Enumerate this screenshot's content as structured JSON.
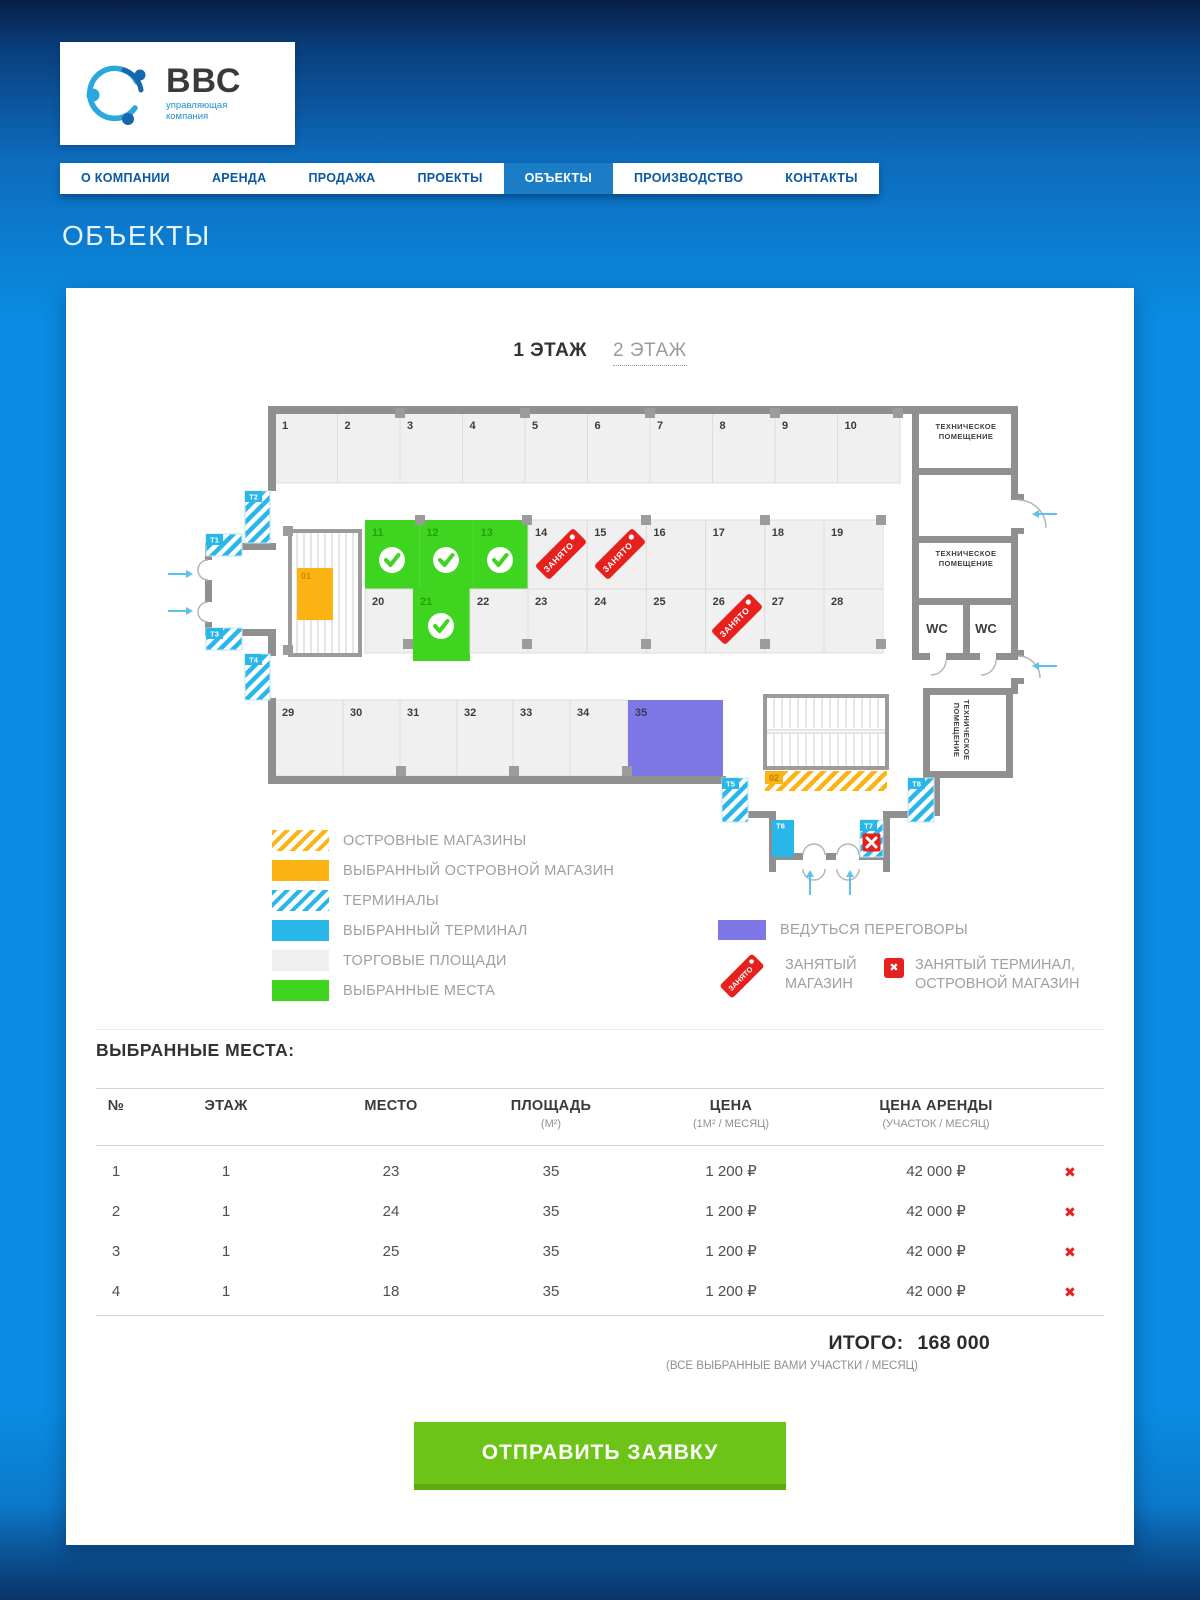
{
  "page_title": "ОБЪЕКТЫ",
  "header": {
    "logo_title": "ВВС",
    "logo_subtitle_line1": "управляющая",
    "logo_subtitle_line2": "компания"
  },
  "nav": {
    "items": [
      {
        "label": "О КОМПАНИИ",
        "active": false
      },
      {
        "label": "АРЕНДА",
        "active": false
      },
      {
        "label": "ПРОДАЖА",
        "active": false
      },
      {
        "label": "ПРОЕКТЫ",
        "active": false
      },
      {
        "label": "ОБЪЕКТЫ",
        "active": true
      },
      {
        "label": "ПРОИЗВОДСТВО",
        "active": false
      },
      {
        "label": "КОНТАКТЫ",
        "active": false
      }
    ]
  },
  "floor_tabs": [
    {
      "label": "1 ЭТАЖ",
      "active": true
    },
    {
      "label": "2 ЭТАЖ",
      "active": false
    }
  ],
  "floorplan": {
    "occupied_label": "ЗАНЯТО",
    "wc_label": "WC",
    "units": [
      {
        "n": "1",
        "x": 115,
        "y": 25,
        "w": 62.5,
        "h": 70,
        "state": "free"
      },
      {
        "n": "2",
        "x": 177.5,
        "y": 25,
        "w": 62.5,
        "h": 70,
        "state": "free"
      },
      {
        "n": "3",
        "x": 240,
        "y": 25,
        "w": 62.5,
        "h": 70,
        "state": "free"
      },
      {
        "n": "4",
        "x": 302.5,
        "y": 25,
        "w": 62.5,
        "h": 70,
        "state": "free"
      },
      {
        "n": "5",
        "x": 365,
        "y": 25,
        "w": 62.5,
        "h": 70,
        "state": "free"
      },
      {
        "n": "6",
        "x": 427.5,
        "y": 25,
        "w": 62.5,
        "h": 70,
        "state": "free"
      },
      {
        "n": "7",
        "x": 490,
        "y": 25,
        "w": 62.5,
        "h": 70,
        "state": "free"
      },
      {
        "n": "8",
        "x": 552.5,
        "y": 25,
        "w": 62.5,
        "h": 70,
        "state": "free"
      },
      {
        "n": "9",
        "x": 615,
        "y": 25,
        "w": 62.5,
        "h": 70,
        "state": "free"
      },
      {
        "n": "10",
        "x": 677.5,
        "y": 25,
        "w": 62.5,
        "h": 70,
        "state": "free"
      },
      {
        "n": "11",
        "x": 205,
        "y": 132,
        "w": 54.3,
        "h": 69,
        "state": "selected"
      },
      {
        "n": "12",
        "x": 259.3,
        "y": 132,
        "w": 54.3,
        "h": 69,
        "state": "selected"
      },
      {
        "n": "13",
        "x": 313.6,
        "y": 132,
        "w": 54.4,
        "h": 69,
        "state": "selected"
      },
      {
        "n": "14",
        "x": 368,
        "y": 132,
        "w": 59.2,
        "h": 69,
        "state": "occupied"
      },
      {
        "n": "15",
        "x": 427.2,
        "y": 132,
        "w": 59.2,
        "h": 69,
        "state": "occupied"
      },
      {
        "n": "16",
        "x": 486.4,
        "y": 132,
        "w": 59.2,
        "h": 69,
        "state": "free"
      },
      {
        "n": "17",
        "x": 545.6,
        "y": 132,
        "w": 59.2,
        "h": 69,
        "state": "free"
      },
      {
        "n": "18",
        "x": 604.8,
        "y": 132,
        "w": 59.2,
        "h": 69,
        "state": "free"
      },
      {
        "n": "19",
        "x": 664,
        "y": 132,
        "w": 59,
        "h": 69,
        "state": "free"
      },
      {
        "n": "20",
        "x": 205,
        "y": 201,
        "w": 48,
        "h": 64,
        "state": "free"
      },
      {
        "n": "21",
        "x": 253,
        "y": 201,
        "w": 57,
        "h": 72,
        "state": "selected"
      },
      {
        "n": "22",
        "x": 310,
        "y": 201,
        "w": 58,
        "h": 64,
        "state": "free"
      },
      {
        "n": "23",
        "x": 368,
        "y": 201,
        "w": 59.2,
        "h": 64,
        "state": "free"
      },
      {
        "n": "24",
        "x": 427.2,
        "y": 201,
        "w": 59.2,
        "h": 64,
        "state": "free"
      },
      {
        "n": "25",
        "x": 486.4,
        "y": 201,
        "w": 59.2,
        "h": 64,
        "state": "free"
      },
      {
        "n": "26",
        "x": 545.6,
        "y": 201,
        "w": 59.2,
        "h": 64,
        "state": "occupied"
      },
      {
        "n": "27",
        "x": 604.8,
        "y": 201,
        "w": 59.2,
        "h": 64,
        "state": "free"
      },
      {
        "n": "28",
        "x": 664,
        "y": 201,
        "w": 59,
        "h": 64,
        "state": "free"
      },
      {
        "n": "29",
        "x": 115,
        "y": 312,
        "w": 68,
        "h": 76,
        "state": "free"
      },
      {
        "n": "30",
        "x": 183,
        "y": 312,
        "w": 57,
        "h": 76,
        "state": "free"
      },
      {
        "n": "31",
        "x": 240,
        "y": 312,
        "w": 57,
        "h": 76,
        "state": "free"
      },
      {
        "n": "32",
        "x": 297,
        "y": 312,
        "w": 56,
        "h": 76,
        "state": "free"
      },
      {
        "n": "33",
        "x": 353,
        "y": 312,
        "w": 57,
        "h": 76,
        "state": "free"
      },
      {
        "n": "34",
        "x": 410,
        "y": 312,
        "w": 58,
        "h": 76,
        "state": "free"
      },
      {
        "n": "35",
        "x": 468,
        "y": 312,
        "w": 95,
        "h": 76,
        "state": "negotiation"
      }
    ],
    "pillars": [
      [
        235,
        20
      ],
      [
        360,
        20
      ],
      [
        485,
        20
      ],
      [
        610,
        20
      ],
      [
        733,
        20
      ],
      [
        255,
        127
      ],
      [
        362,
        127
      ],
      [
        481,
        127
      ],
      [
        600,
        127
      ],
      [
        716,
        127
      ],
      [
        243,
        251
      ],
      [
        362,
        251
      ],
      [
        481,
        251
      ],
      [
        600,
        251
      ],
      [
        716,
        251
      ],
      [
        123,
        138
      ],
      [
        123,
        257
      ],
      [
        236,
        378
      ],
      [
        349,
        378
      ],
      [
        462,
        378
      ]
    ],
    "checks": [
      [
        232,
        172
      ],
      [
        286,
        172
      ],
      [
        340,
        172
      ],
      [
        281,
        238
      ]
    ],
    "tags": [
      [
        401,
        166
      ],
      [
        460,
        166
      ],
      [
        577,
        231
      ]
    ],
    "terminals": [
      {
        "id": "T1",
        "x": 46,
        "y": 146,
        "w": 36,
        "h": 22,
        "type": "hatch"
      },
      {
        "id": "T2",
        "x": 85,
        "y": 103,
        "w": 25,
        "h": 52,
        "type": "hatch"
      },
      {
        "id": "T3",
        "x": 46,
        "y": 240,
        "w": 36,
        "h": 22,
        "type": "hatch"
      },
      {
        "id": "T4",
        "x": 85,
        "y": 266,
        "w": 25,
        "h": 46,
        "type": "hatch"
      },
      {
        "id": "T5",
        "x": 562,
        "y": 390,
        "w": 26,
        "h": 44,
        "type": "hatch"
      },
      {
        "id": "T6",
        "x": 612,
        "y": 432,
        "w": 22,
        "h": 37,
        "type": "solid"
      },
      {
        "id": "T7",
        "x": 700,
        "y": 432,
        "w": 23,
        "h": 37,
        "type": "occupied"
      },
      {
        "id": "T8",
        "x": 748,
        "y": 390,
        "w": 26,
        "h": 44,
        "type": "hatch"
      }
    ],
    "islands": [
      {
        "id": "01",
        "x": 137,
        "y": 180,
        "w": 36,
        "h": 52,
        "type": "solid"
      },
      {
        "id": "02",
        "x": 605,
        "y": 383,
        "w": 122,
        "h": 20,
        "type": "hatch"
      }
    ],
    "tech_rooms": [
      {
        "x": 806,
        "y": 41,
        "rot": 0,
        "lines": [
          "ТЕХНИЧЕСКОЕ",
          "ПОМЕЩЕНИЕ"
        ]
      },
      {
        "x": 806,
        "y": 168,
        "rot": 0,
        "lines": [
          "ТЕХНИЧЕСКОЕ",
          "ПОМЕЩЕНИЕ"
        ]
      },
      {
        "x": 804,
        "y": 342,
        "rot": 90,
        "lines": [
          "ТЕХНИЧЕСКОЕ",
          "ПОМЕЩЕНИЕ"
        ]
      }
    ],
    "wc_positions": [
      [
        777,
        245
      ],
      [
        826,
        245
      ]
    ],
    "arrows": [
      {
        "x": 8,
        "y": 186,
        "dir": "right"
      },
      {
        "x": 8,
        "y": 223,
        "dir": "right"
      },
      {
        "x": 897,
        "y": 126,
        "dir": "left"
      },
      {
        "x": 897,
        "y": 278,
        "dir": "left"
      },
      {
        "x": 650,
        "y": 507,
        "dir": "up"
      },
      {
        "x": 690,
        "y": 507,
        "dir": "up"
      }
    ]
  },
  "legend": {
    "left": [
      {
        "label": "ОСТРОВНЫЕ МАГАЗИНЫ",
        "swatch": "hatch-o"
      },
      {
        "label": "ВЫБРАННЫЙ ОСТРОВНОЙ МАГАЗИН",
        "swatch": "solid-o"
      },
      {
        "label": "ТЕРМИНАЛЫ",
        "swatch": "hatch-b"
      },
      {
        "label": "ВЫБРАННЫЙ ТЕРМИНАЛ",
        "swatch": "solid-b"
      },
      {
        "label": "ТОРГОВЫЕ ПЛОЩАДИ",
        "swatch": "gray"
      },
      {
        "label": "ВЫБРАННЫЕ МЕСТА",
        "swatch": "green"
      }
    ],
    "right": {
      "negotiation_label": "ВЕДУТЬСЯ ПЕРЕГОВОРЫ",
      "occupied_shop_line1": "ЗАНЯТЫЙ",
      "occupied_shop_line2": "МАГАЗИН",
      "occupied_terminal_line1": "ЗАНЯТЫЙ ТЕРМИНАЛ,",
      "occupied_terminal_line2": "ОСТРОВНОЙ МАГАЗИН",
      "x_glyph": "✖"
    }
  },
  "table": {
    "heading": "ВЫБРАННЫЕ МЕСТА:",
    "columns": [
      {
        "label": "№",
        "sub": ""
      },
      {
        "label": "ЭТАЖ",
        "sub": ""
      },
      {
        "label": "МЕСТО",
        "sub": ""
      },
      {
        "label": "ПЛОЩАДЬ",
        "sub": "(М²)"
      },
      {
        "label": "ЦЕНА",
        "sub": "(1М² / МЕСЯЦ)"
      },
      {
        "label": "ЦЕНА АРЕНДЫ",
        "sub": "(УЧАСТОК / МЕСЯЦ)"
      }
    ],
    "rows": [
      [
        "1",
        "1",
        "23",
        "35",
        "1 200 ₽",
        "42 000 ₽"
      ],
      [
        "2",
        "1",
        "24",
        "35",
        "1 200 ₽",
        "42 000 ₽"
      ],
      [
        "3",
        "1",
        "25",
        "35",
        "1 200 ₽",
        "42 000 ₽"
      ],
      [
        "4",
        "1",
        "18",
        "35",
        "1 200 ₽",
        "42 000 ₽"
      ]
    ],
    "remove_glyph": "✖"
  },
  "totals": {
    "label": "ИТОГО:",
    "value": "168 000",
    "note": "(ВСЕ ВЫБРАННЫЕ ВАМИ УЧАСТКИ / МЕСЯЦ)"
  },
  "submit_label": "ОТПРАВИТЬ ЗАЯВКУ",
  "colors": {
    "green": "#3fd41f",
    "orange": "#fcb414",
    "light_blue": "#29b7ea",
    "purple": "#7e78e7",
    "red": "#e6201d",
    "button_green": "#6cc417",
    "nav_active": "#1a7dc6"
  }
}
